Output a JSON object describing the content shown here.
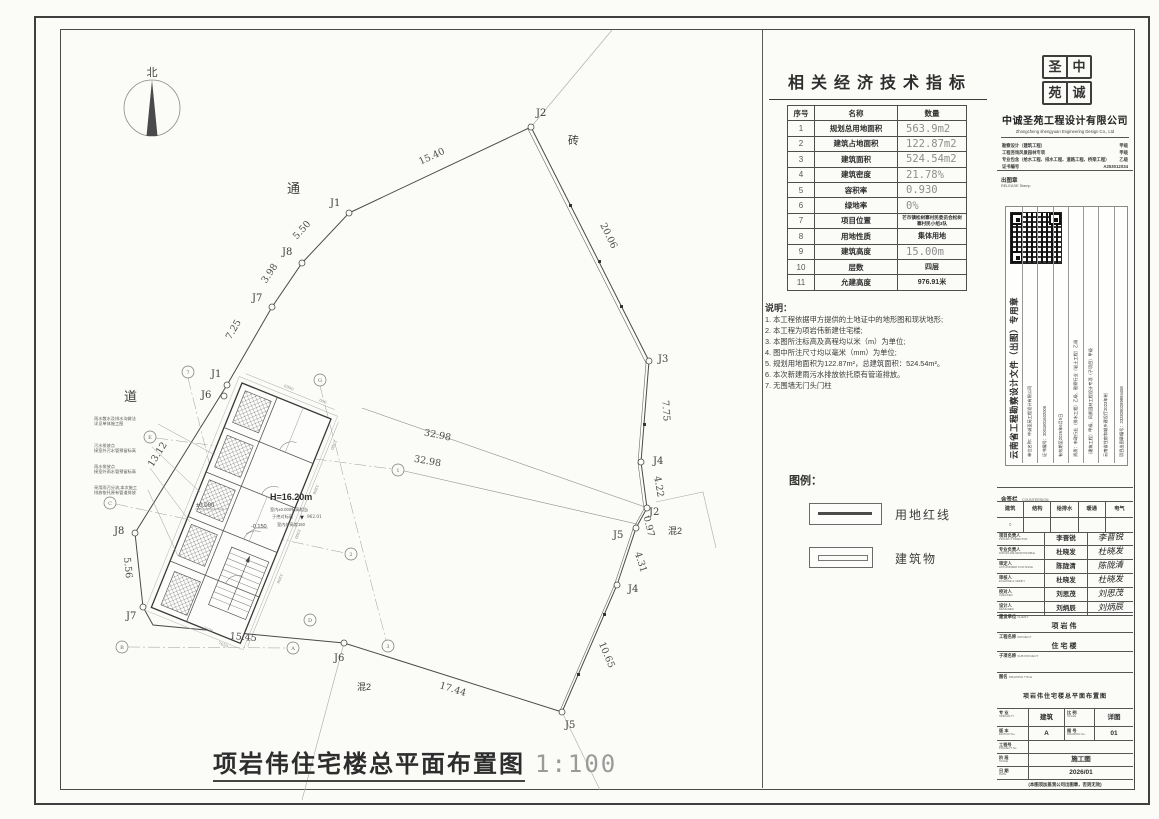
{
  "plan": {
    "north": "北",
    "road1": "通",
    "road2": "道",
    "brick": "砖",
    "mix_a": "混2",
    "mix_b": "混2",
    "title": "项岩伟住宅楼总平面布置图",
    "scale": "1:100",
    "height": "H=16.20m",
    "lv0": "±0.000",
    "lvm": "-0.150",
    "elev1": "室内±0.000标高相当",
    "elev2": "于绝对标高",
    "level_icon": "▼",
    "elev_val": "962.01",
    "elev3": "室内外高差150",
    "points": [
      {
        "id": "J1"
      },
      {
        "id": "J2"
      },
      {
        "id": "J3"
      },
      {
        "id": "J4"
      },
      {
        "id": "J2"
      },
      {
        "id": "J5"
      },
      {
        "id": "J4"
      },
      {
        "id": "J5"
      },
      {
        "id": "J6"
      },
      {
        "id": "J7"
      },
      {
        "id": "J8"
      },
      {
        "id": "J1"
      },
      {
        "id": "J6"
      },
      {
        "id": "J7"
      },
      {
        "id": "J8"
      }
    ],
    "dims": [
      {
        "t": "15.40"
      },
      {
        "t": "20.06"
      },
      {
        "t": "7.75"
      },
      {
        "t": "4.22"
      },
      {
        "t": "0.97"
      },
      {
        "t": "4.31"
      },
      {
        "t": "10.65"
      },
      {
        "t": "17.44"
      },
      {
        "t": "15.45"
      },
      {
        "t": "5.56"
      },
      {
        "t": "13.12"
      },
      {
        "t": "7.25"
      },
      {
        "t": "3.98"
      },
      {
        "t": "5.50"
      },
      {
        "t": "32.98"
      },
      {
        "t": "32.98"
      }
    ],
    "bubbles": [
      {
        "t": "7"
      },
      {
        "t": "G"
      },
      {
        "t": "1"
      },
      {
        "t": "2"
      },
      {
        "t": "3"
      },
      {
        "t": "C"
      },
      {
        "t": "B"
      },
      {
        "t": "A"
      },
      {
        "t": "D"
      },
      {
        "t": "E"
      }
    ],
    "small_dims": [
      "6900",
      "600",
      "3300",
      "3300",
      "3300",
      "3300",
      "2978",
      "7650"
    ],
    "leaders": [
      {
        "l1": "雨水散水及排水沟做法",
        "l2": "详见单体施工图"
      },
      {
        "l1": "污水排放点",
        "l2": "接室外污水管预留标高"
      },
      {
        "l1": "雨水排放点",
        "l2": "接室外雨水管预留标高"
      },
      {
        "l1": "采用雨污分流,本次施工",
        "l2": "排放依托原有管道排放"
      }
    ]
  },
  "indicators": {
    "title": "相关经济技术指标",
    "headers": [
      "序号",
      "名称",
      "数量"
    ],
    "rows": [
      [
        "1",
        "规划总用地面积",
        "563.9m2"
      ],
      [
        "2",
        "建筑占地面积",
        "122.87m2"
      ],
      [
        "3",
        "建筑面积",
        "524.54m2"
      ],
      [
        "4",
        "建筑密度",
        "21.78%"
      ],
      [
        "5",
        "容积率",
        "0.930"
      ],
      [
        "6",
        "绿地率",
        "0%"
      ],
      [
        "7",
        "项目位置",
        "芒市镇松树寨村民委员会松树寨村民小组3队"
      ],
      [
        "8",
        "用地性质",
        "集体用地"
      ],
      [
        "9",
        "建筑高度",
        "15.00m"
      ],
      [
        "10",
        "层数",
        "四层"
      ],
      [
        "11",
        "允建高度",
        "976.91米"
      ]
    ]
  },
  "notes": {
    "title": "说明：",
    "items": [
      "1. 本工程依据甲方提供的土地证中的地形图和现状地形;",
      "2. 本工程为项岩伟新建住宅楼;",
      "3. 本图所注标高及高程均以米（m）为单位;",
      "4. 图中所注尺寸均以毫米（mm）为单位;",
      "5. 规划用地面积为122.87m²，总建筑面积：524.54m²。",
      "6. 本次新建雨污水排放依托原有管道排放。",
      "7. 无围墙无门头门柱"
    ]
  },
  "legend": {
    "title": "图例：",
    "items": [
      "用地红线",
      "建筑物"
    ]
  },
  "tblock": {
    "logo": [
      "圣",
      "中",
      "苑",
      "诚"
    ],
    "company_cn": "中诚圣苑工程设计有限公司",
    "company_en": "Zhongcheng shengyuan Engineering Design Co., Ltd",
    "quals": [
      {
        "t": "勘察设计（建筑工程）",
        "g": "甲级"
      },
      {
        "t": "工程咨询风景园林专项",
        "g": "甲级"
      },
      {
        "t": "专业包含（给水工程、排水工程、道路工程、桥梁工程）",
        "g": "乙级"
      },
      {
        "t": "证书编号",
        "g": "A253012034"
      }
    ],
    "release_cn": "出图章",
    "release_en": "RELEASE Stamp",
    "stamp": {
      "title": "云南省工程勘察设计文件（出图）专用章",
      "rows": [
        "单位名称：中诚圣苑工程设计有限公司",
        "证书编号：2001801602006",
        "有效期至2026年6月5日",
        "资质：市政行业（排水工程）乙级、勘察行业（岩土工程）乙级",
        "（建筑工程）甲级、风景园林工程设计专项（子项目）甲级",
        "云南省住房和城乡建设厅2023年制",
        "项目出图章编号：2328280289894468"
      ]
    },
    "countersign_cn": "会签栏",
    "countersign_en": "COUNTERSIGN",
    "disciplines": [
      "建筑",
      "结构",
      "给排水",
      "暖通",
      "电气"
    ],
    "mark": "○",
    "sigs": [
      {
        "cn": "项目负责人",
        "en": "PROJECT DIRECTOR",
        "name": "李晋锐",
        "sig": "李晋锐"
      },
      {
        "cn": "专业负责人",
        "en": "DISCIPLINE RESPONSIBLE",
        "name": "杜晓发",
        "sig": "杜晓发"
      },
      {
        "cn": "审定人",
        "en": "AUTHORIZER FOR ISSUE",
        "name": "陈陇清",
        "sig": "陈陇清"
      },
      {
        "cn": "审核人",
        "en": "EXAMINE & VERIFY",
        "name": "杜晓发",
        "sig": "杜晓发"
      },
      {
        "cn": "校对人",
        "en": "CHECKED",
        "name": "刘思茂",
        "sig": "刘思茂"
      },
      {
        "cn": "设计人",
        "en": "DESIGNED",
        "name": "刘炳辰",
        "sig": "刘炳辰"
      }
    ],
    "client_rows": [
      {
        "cn": "建设单位",
        "en": "CLIENT",
        "val": "项岩伟"
      },
      {
        "cn": "工程名称",
        "en": "PROJECT",
        "val": "住宅楼"
      },
      {
        "cn": "子项名称",
        "en": "SUB PROJECT",
        "val": ""
      }
    ],
    "drawing": {
      "cn": "图名",
      "en": "DRAWING TITLE",
      "val": "项岩伟住宅楼总平面布置图"
    },
    "grid": {
      "specialty_cn": "专 业",
      "specialty_en": "SPECIALTY",
      "specialty_val": "建筑",
      "scale_cn": "比 例",
      "scale_en": "SCALE",
      "scale_val": "详图",
      "edition_cn": "版 本",
      "edition_en": "EDITION No.",
      "edition_val": "A",
      "drawno_cn": "图 号",
      "drawno_en": "DRAWING No.",
      "drawno_val": "01",
      "projno_cn": "工程号",
      "projno_en": "PROJECT No.",
      "projno_val": "",
      "stage_cn": "阶 段",
      "stage_en": "STAGE",
      "stage_val": "施工图",
      "date_cn": "日 期",
      "date_en": "DATE",
      "date_val": "2026/01"
    },
    "footer": "(本图须加盖我公司出图章，否则无效)"
  }
}
